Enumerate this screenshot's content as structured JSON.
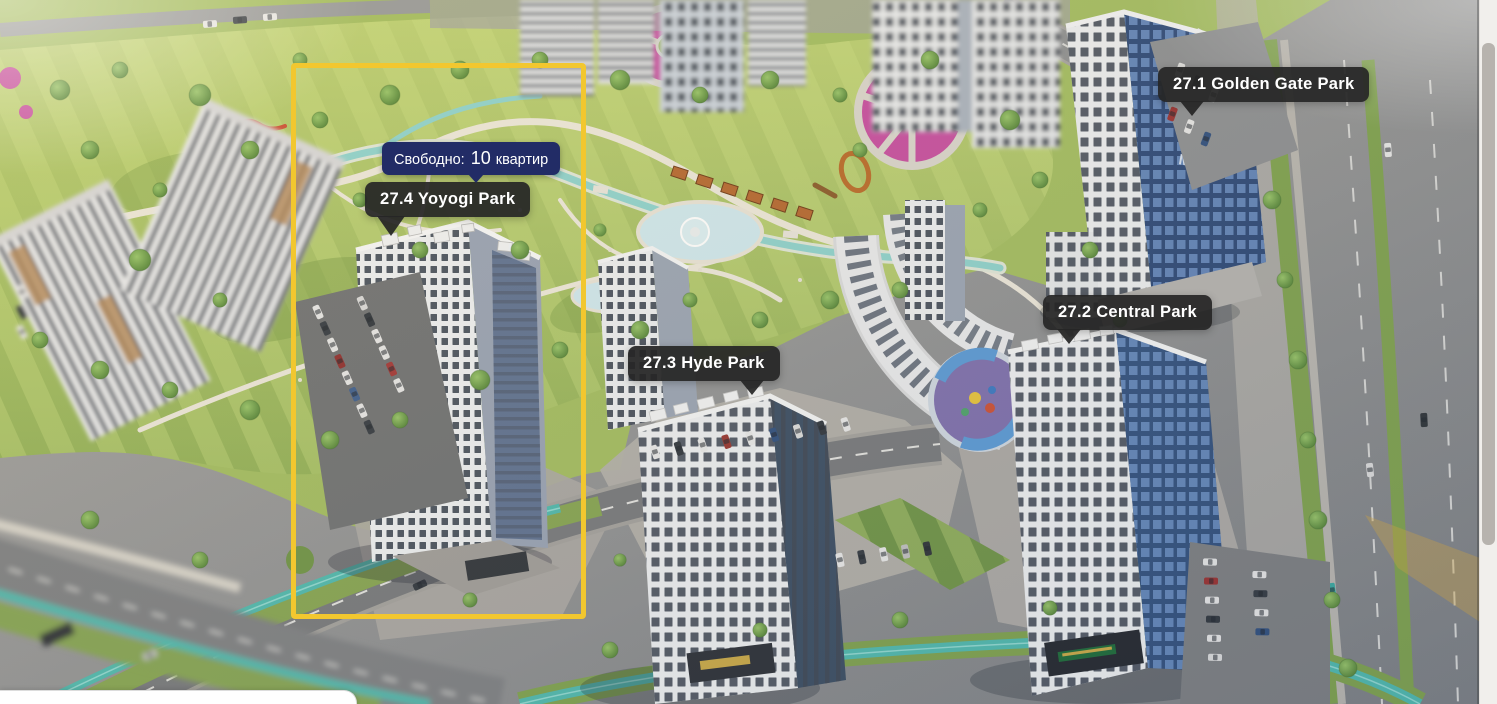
{
  "site_plan": {
    "highlight_color": "#F2C72F",
    "marker_bg_color": "#262626",
    "tooltip_bg_color": "#222C66",
    "building_logo": "MW",
    "markers": [
      {
        "id": "27.1",
        "name": "Golden Gate Park",
        "label": "27.1 Golden Gate Park",
        "highlighted": false
      },
      {
        "id": "27.2",
        "name": "Central Park",
        "label": "27.2 Central Park",
        "highlighted": false
      },
      {
        "id": "27.3",
        "name": "Hyde Park",
        "label": "27.3 Hyde Park",
        "highlighted": false
      },
      {
        "id": "27.4",
        "name": "Yoyogi Park",
        "label": "27.4 Yoyogi Park",
        "highlighted": true
      }
    ],
    "availability_tooltip": {
      "label": "Свободно:",
      "count": "10",
      "unit": "квартир",
      "text": "Свободно: 10 квартир"
    }
  }
}
